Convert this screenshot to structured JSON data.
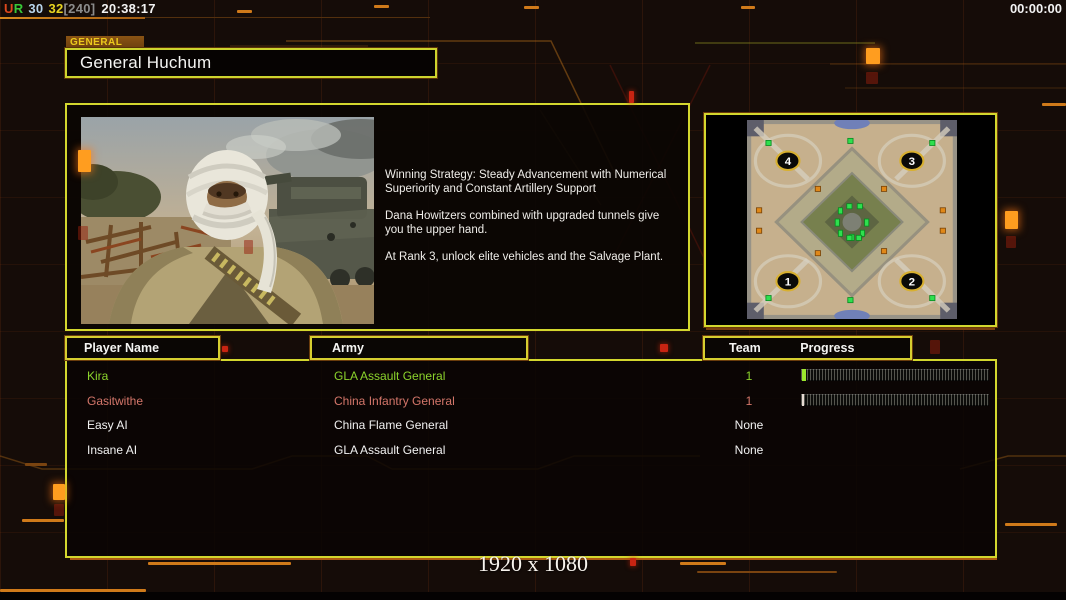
{
  "top_bar": {
    "gentool": {
      "u": "U",
      "r": "R",
      "v1": "30",
      "v2": "32",
      "fps": "[240]",
      "clock": "20:38:17"
    },
    "match_timer": "00:00:00"
  },
  "general_panel": {
    "tab_label": "GENERAL",
    "general_name": "General Huchum",
    "strategy": [
      "Winning Strategy: Steady Advancement with Numerical\n Superiority and Constant Artillery Support",
      "Dana Howitzers combined with upgraded tunnels give\n you the upper hand.",
      "At Rank 3, unlock elite vehicles and the Salvage Plant."
    ]
  },
  "map_preview": {
    "start_positions": [
      {
        "label": "4",
        "corner": "top-left"
      },
      {
        "label": "3",
        "corner": "top-right"
      },
      {
        "label": "1",
        "corner": "bottom-left"
      },
      {
        "label": "2",
        "corner": "bottom-right"
      }
    ]
  },
  "player_table": {
    "headers": {
      "player_name": "Player Name",
      "army": "Army",
      "team": "Team",
      "progress": "Progress"
    },
    "rows": [
      {
        "player": "Kira",
        "army": "GLA Assault General",
        "team": "1",
        "color": "#8cd42c",
        "progress": true,
        "tick": "#9ae62e",
        "tick_width": 4
      },
      {
        "player": "Gasitwithe",
        "army": "China Infantry General",
        "team": "1",
        "color": "#d4766a",
        "progress": true,
        "tick": "#e6dad2",
        "tick_width": 2
      },
      {
        "player": "Easy AI",
        "army": "China Flame General",
        "team": "None",
        "color": "#f2f2f2",
        "progress": false,
        "tick": "",
        "tick_width": 0
      },
      {
        "player": "Insane AI",
        "army": "GLA Assault General",
        "team": "None",
        "color": "#f2f2f2",
        "progress": false,
        "tick": "",
        "tick_width": 0
      }
    ]
  },
  "footer": {
    "resolution": "1920 x 1080"
  },
  "colors": {
    "panel_border": "#d3d72e",
    "accent_orange": "#e08a1e",
    "player_green": "#8cd42c",
    "player_salmon": "#d4766a"
  }
}
